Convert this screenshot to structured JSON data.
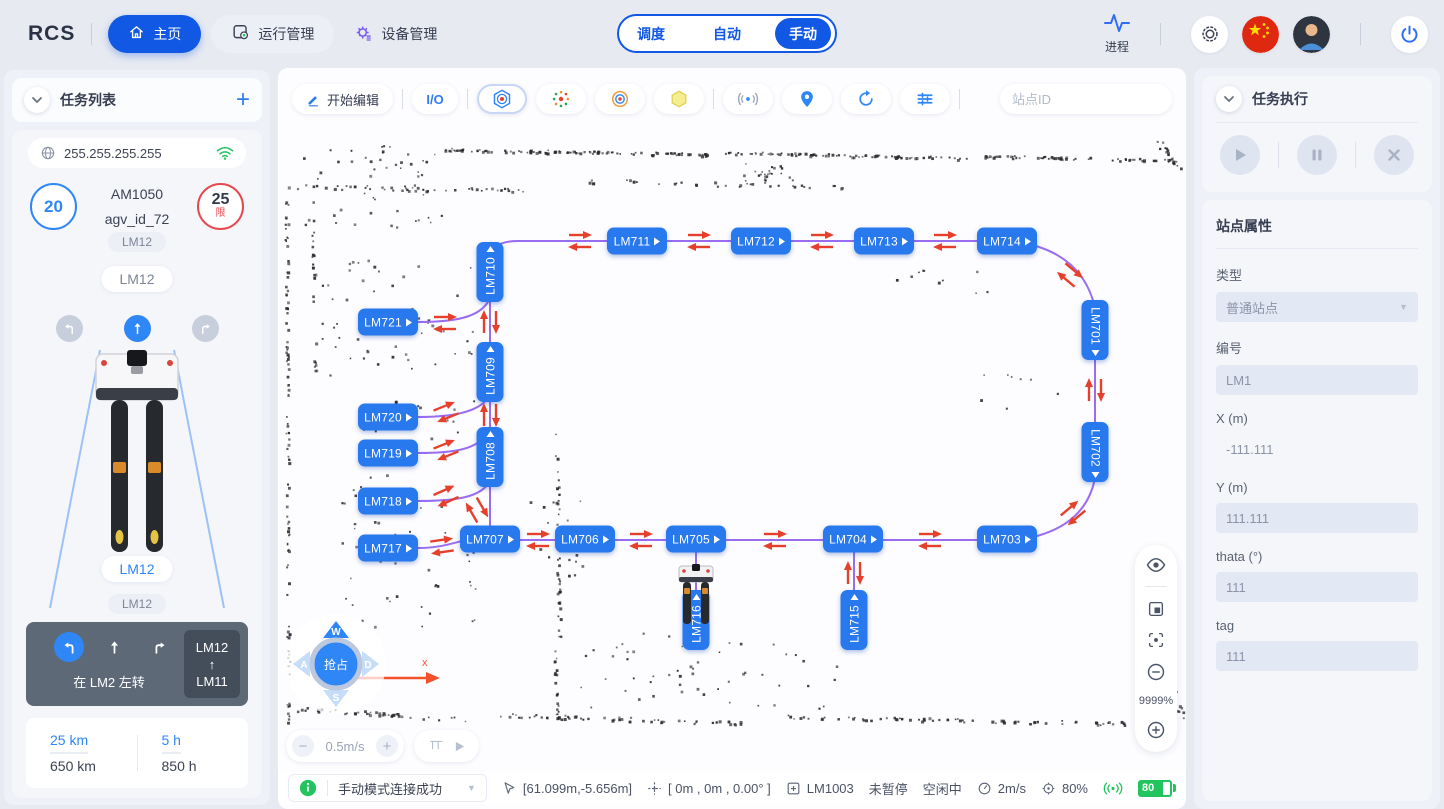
{
  "colors": {
    "primary": "#1158e5",
    "station": "#2878ee",
    "route": "#9a6cf0",
    "arrow": "#e6402c",
    "success": "#21c45d"
  },
  "header": {
    "logo": "RCS",
    "nav_home": "主页",
    "nav_ops": "运行管理",
    "nav_devices": "设备管理",
    "tab_dispatch": "调度",
    "tab_auto": "自动",
    "tab_manual": "手动",
    "process": "进程"
  },
  "left": {
    "title": "任务列表",
    "ip": "255.255.255.255",
    "speed": "20",
    "limit": "25",
    "limit_tag": "限",
    "model": "AM1050",
    "agv_id": "agv_id_72",
    "chip1": "LM12",
    "pill1": "LM12",
    "pill2": "LM12",
    "chip2": "LM12",
    "nav_hint": "在 LM2 左转",
    "route_from": "LM12",
    "route_arrow": "↑",
    "route_to": "LM11",
    "odo_value": "25 km",
    "odo_total": "650 km",
    "hours_value": "5 h",
    "hours_total": "850 h"
  },
  "map": {
    "toolbar": {
      "edit": "开始编辑",
      "io": "I/O",
      "search_placeholder": "站点ID"
    },
    "zoom": "9999%",
    "joystick": {
      "up": "W",
      "left": "A",
      "down": "S",
      "right": "D",
      "center": "抢占"
    },
    "speed": "0.5m/s",
    "axis": "x",
    "stations": [
      {
        "id": "LM711",
        "x": 359,
        "y": 173,
        "o": "h"
      },
      {
        "id": "LM712",
        "x": 483,
        "y": 173,
        "o": "h"
      },
      {
        "id": "LM713",
        "x": 606,
        "y": 173,
        "o": "h"
      },
      {
        "id": "LM714",
        "x": 729,
        "y": 173,
        "o": "h"
      },
      {
        "id": "LM710",
        "x": 212,
        "y": 204,
        "o": "vt"
      },
      {
        "id": "LM721",
        "x": 110,
        "y": 254,
        "o": "h"
      },
      {
        "id": "LM709",
        "x": 212,
        "y": 304,
        "o": "vt"
      },
      {
        "id": "LM720",
        "x": 110,
        "y": 349,
        "o": "h"
      },
      {
        "id": "LM719",
        "x": 110,
        "y": 385,
        "o": "h"
      },
      {
        "id": "LM708",
        "x": 212,
        "y": 389,
        "o": "vt"
      },
      {
        "id": "LM718",
        "x": 110,
        "y": 433,
        "o": "h"
      },
      {
        "id": "LM717",
        "x": 110,
        "y": 480,
        "o": "h"
      },
      {
        "id": "LM707",
        "x": 212,
        "y": 471,
        "o": "h"
      },
      {
        "id": "LM706",
        "x": 307,
        "y": 471,
        "o": "h"
      },
      {
        "id": "LM705",
        "x": 418,
        "y": 471,
        "o": "h"
      },
      {
        "id": "LM704",
        "x": 575,
        "y": 471,
        "o": "h"
      },
      {
        "id": "LM703",
        "x": 729,
        "y": 471,
        "o": "h"
      },
      {
        "id": "LM701",
        "x": 817,
        "y": 262,
        "o": "vb"
      },
      {
        "id": "LM702",
        "x": 817,
        "y": 384,
        "o": "vb"
      },
      {
        "id": "LM716",
        "x": 418,
        "y": 552,
        "o": "vt"
      },
      {
        "id": "LM715",
        "x": 576,
        "y": 552,
        "o": "vt"
      }
    ],
    "edges": [
      "M 212,192 Q 212,173 240,173 L 734,173",
      "M 734,173 Q 804,182 817,240",
      "M 817,240 L 817,410",
      "M 817,410 Q 807,462 740,472",
      "M 740,472 L 187,472",
      "M 212,470 L 212,178",
      "M 140,254 C 175,254 202,250 211,232",
      "M 140,349 C 175,349 200,344 210,330",
      "M 140,385 C 175,385 200,382 210,364",
      "M 140,433 C 175,433 200,430 210,416",
      "M 140,480 C 160,480 172,476 184,473",
      "M 418,484 L 418,552",
      "M 576,484 L 576,552"
    ],
    "arrows": [
      {
        "x": 302,
        "y": 173,
        "r": 0
      },
      {
        "x": 421,
        "y": 173,
        "r": 0
      },
      {
        "x": 544,
        "y": 173,
        "r": 0
      },
      {
        "x": 667,
        "y": 173,
        "r": 0
      },
      {
        "x": 792,
        "y": 207,
        "r": 40
      },
      {
        "x": 817,
        "y": 322,
        "r": 90
      },
      {
        "x": 795,
        "y": 445,
        "r": 140
      },
      {
        "x": 652,
        "y": 472,
        "r": 0
      },
      {
        "x": 497,
        "y": 472,
        "r": 0
      },
      {
        "x": 363,
        "y": 472,
        "r": 0
      },
      {
        "x": 260,
        "y": 472,
        "r": 0
      },
      {
        "x": 576,
        "y": 505,
        "r": 90
      },
      {
        "x": 212,
        "y": 254,
        "r": 90
      },
      {
        "x": 212,
        "y": 347,
        "r": 90
      },
      {
        "x": 199,
        "y": 442,
        "r": 60
      },
      {
        "x": 167,
        "y": 255,
        "r": 0
      },
      {
        "x": 168,
        "y": 344,
        "r": -22
      },
      {
        "x": 168,
        "y": 382,
        "r": -22
      },
      {
        "x": 168,
        "y": 428,
        "r": -24
      },
      {
        "x": 164,
        "y": 478,
        "r": -8
      }
    ],
    "robot": {
      "x": 418,
      "y": 522
    }
  },
  "status": {
    "message": "手动模式连接成功",
    "coords": "[61.099m,-5.656m]",
    "pose": "[ 0m , 0m , 0.00° ]",
    "station": "LM1003",
    "pause": "未暂停",
    "state": "空闲中",
    "speed": "2m/s",
    "progress": "80%",
    "battery": "80"
  },
  "right": {
    "exec_title": "任务执行",
    "props_title": "站点属性",
    "type_label": "类型",
    "type_value": "普通站点",
    "code_label": "编号",
    "code_value": "LM1",
    "x_label": "X (m)",
    "x_value": "-111.111",
    "y_label": "Y (m)",
    "y_value": "111.111",
    "theta_label": "thata (°)",
    "theta_value": "111",
    "tag_label": "tag",
    "tag_value": "111"
  }
}
